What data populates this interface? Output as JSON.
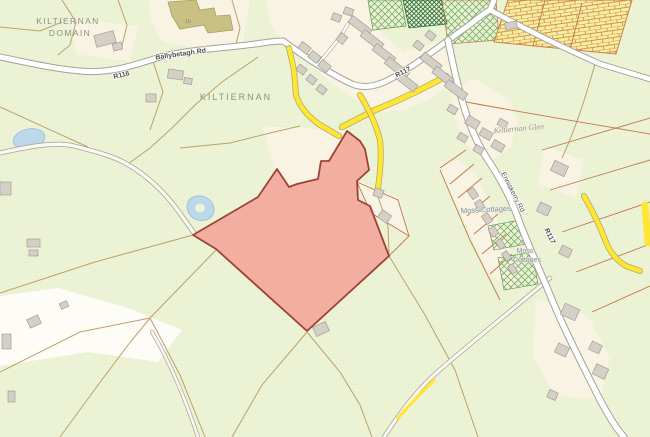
{
  "map": {
    "labels": {
      "domain_line1": "KILTIERNAN",
      "domain_line2": "DOMAIN",
      "village": "KILTIERNAN",
      "ballybetagh_rd": "Ballybetagh Rd",
      "r116": "R116",
      "r117_north": "R117",
      "r117_south": "R117",
      "enniskerry_rd": "Enniskerry Rd",
      "estate": "Kiltiernan Glen",
      "moss_cottages": "Moss Cottages",
      "moss_line1": "Moss",
      "moss_line2": "Cottages",
      "building_ref": "1b"
    },
    "colors": {
      "background_field": "#ecf3d6",
      "field_texture": "#e2edc6",
      "cream_area": "#f8f3e2",
      "white_area": "#fdfcf6",
      "highlight_parcel_fill": "#f2a69b",
      "highlight_parcel_border": "#9e4237",
      "road_fill": "#ffffff",
      "road_casing": "#a5a29a",
      "track_fill": "#faf8ef",
      "yellow_road": "#ffe632",
      "yellow_casing": "#b3ab6a",
      "boundary_olive": "#bfa06c",
      "boundary_red": "#c1764e",
      "building_fill": "#d4d0c8",
      "building_stroke": "#a49d93",
      "khaki_building": "#c9c083",
      "khaki_stroke": "#a89f62",
      "water": "#bdd8ea",
      "water_edge": "#8fb8d6",
      "hatch_green": "#79af66",
      "hatch_dark_green": "#2e6f3c",
      "brick_fill": "#f5efa3",
      "brick_line": "#d9924f",
      "label_grey": "#8b9186",
      "road_label": "#4f4f48",
      "estate_label": "#9b9b90",
      "cottage_label": "#8a8fa8"
    }
  }
}
